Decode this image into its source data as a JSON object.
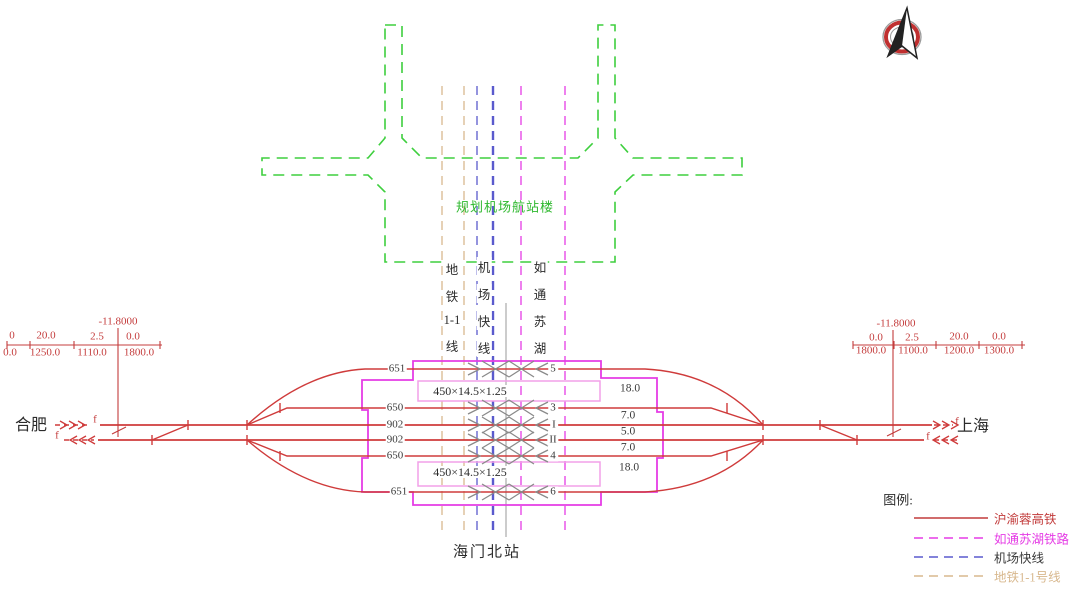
{
  "drawing": {
    "station_name": "海门北站",
    "direction_left": "合肥",
    "direction_right": "上海",
    "building_label": "规划机场航站楼",
    "marker_f": "f"
  },
  "corridors": {
    "metro": {
      "chars": [
        "地",
        "铁",
        "1-1",
        "线"
      ]
    },
    "airport_express": {
      "chars": [
        "机",
        "场",
        "快",
        "线"
      ]
    },
    "rutong_suhu": {
      "chars": [
        "如",
        "通",
        "苏",
        "湖"
      ]
    }
  },
  "tracks": {
    "lengths": [
      "651",
      "650",
      "902",
      "902",
      "650",
      "651"
    ],
    "numbers": [
      "5",
      "3",
      "I",
      "II",
      "4",
      "6"
    ],
    "spacings": [
      "18.0",
      "7.0",
      "5.0",
      "7.0",
      "18.0"
    ],
    "platform_dim_top": "450×14.5×1.25",
    "platform_dim_bottom": "450×14.5×1.25"
  },
  "profiles": {
    "left": {
      "elevation": "-11.8000",
      "grades": [
        "0",
        "20.0",
        "2.5",
        "0.0"
      ],
      "lengths": [
        "0.0",
        "1250.0",
        "1110.0",
        "1800.0"
      ]
    },
    "right": {
      "elevation": "-11.8000",
      "grades": [
        "0.0",
        "2.5",
        "20.0",
        "0.0"
      ],
      "lengths": [
        "1800.0",
        "1100.0",
        "1200.0",
        "1300.0"
      ]
    }
  },
  "legend": {
    "title": "图例:",
    "items": [
      {
        "label": "沪渝蓉高铁",
        "color": "#c23b3b",
        "style": "solid"
      },
      {
        "label": "如通苏湖铁路",
        "color": "#e53ce5",
        "style": "dashed"
      },
      {
        "label": "机场快线",
        "color": "#5a5acd",
        "style": "dashed"
      },
      {
        "label": "地铁1-1号线",
        "color": "#d8b88e",
        "style": "dashed"
      }
    ]
  },
  "colors": {
    "main_rail": "#cf3b3b",
    "station_boundary": "#e53ce5",
    "platform": "#f2a0e8",
    "building": "#3ecf3e",
    "annotation_gray": "#8a8a8a"
  }
}
